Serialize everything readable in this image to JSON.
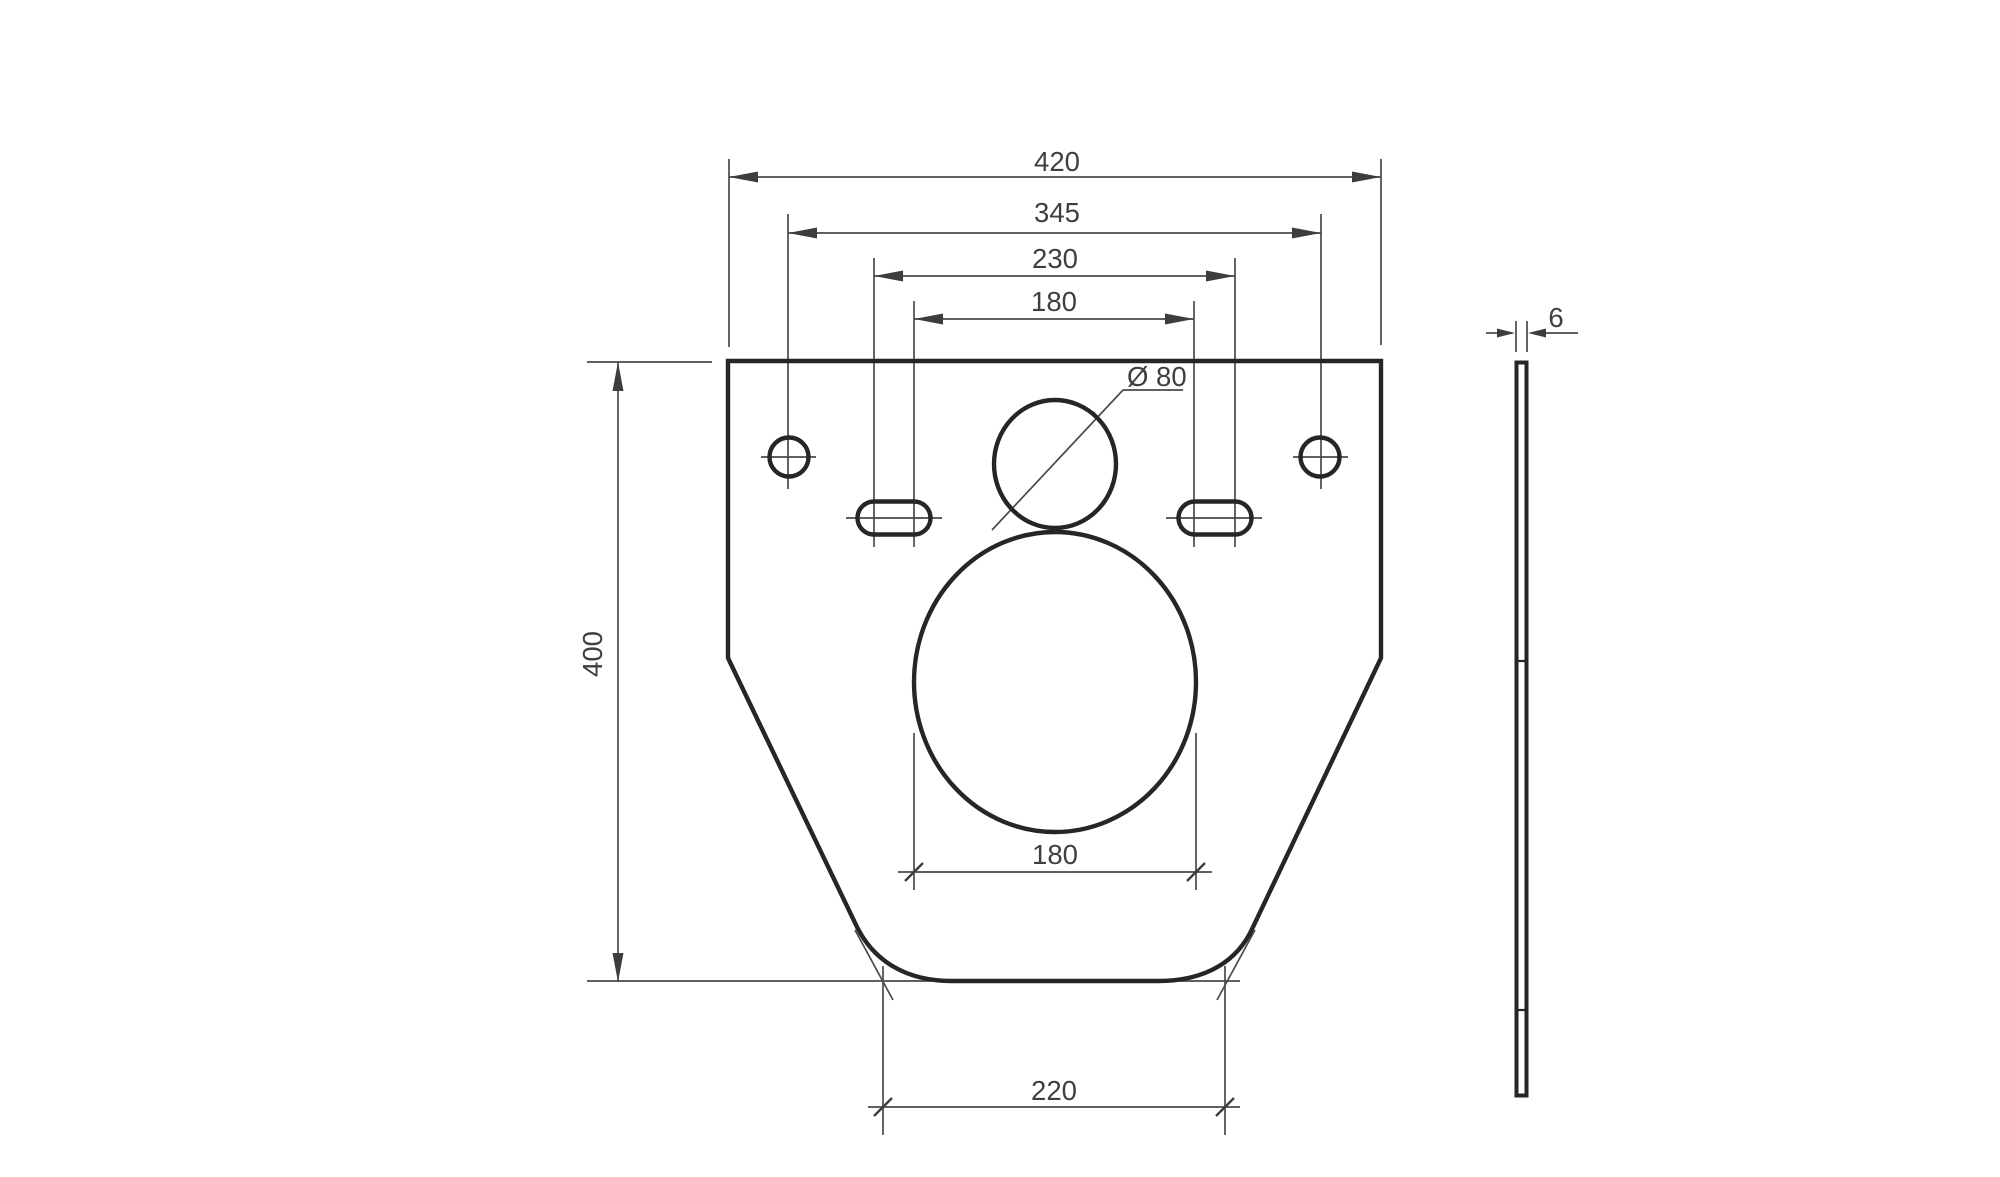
{
  "drawing": {
    "front": {
      "top_width": "420",
      "hole_spacing": "345",
      "slot_outer_spacing": "230",
      "slot_inner_spacing": "180",
      "height": "400",
      "small_opening_diameter": "Ø 80",
      "opening_width": "180",
      "bottom_width": "220"
    },
    "side": {
      "thickness": "6"
    },
    "colors": {
      "outline": "#262626",
      "dimension_lines": "#4a4a4a",
      "arrow_fill": "#3d3d3d",
      "label_text": "#3f3f3f",
      "background": "#ffffff"
    }
  }
}
